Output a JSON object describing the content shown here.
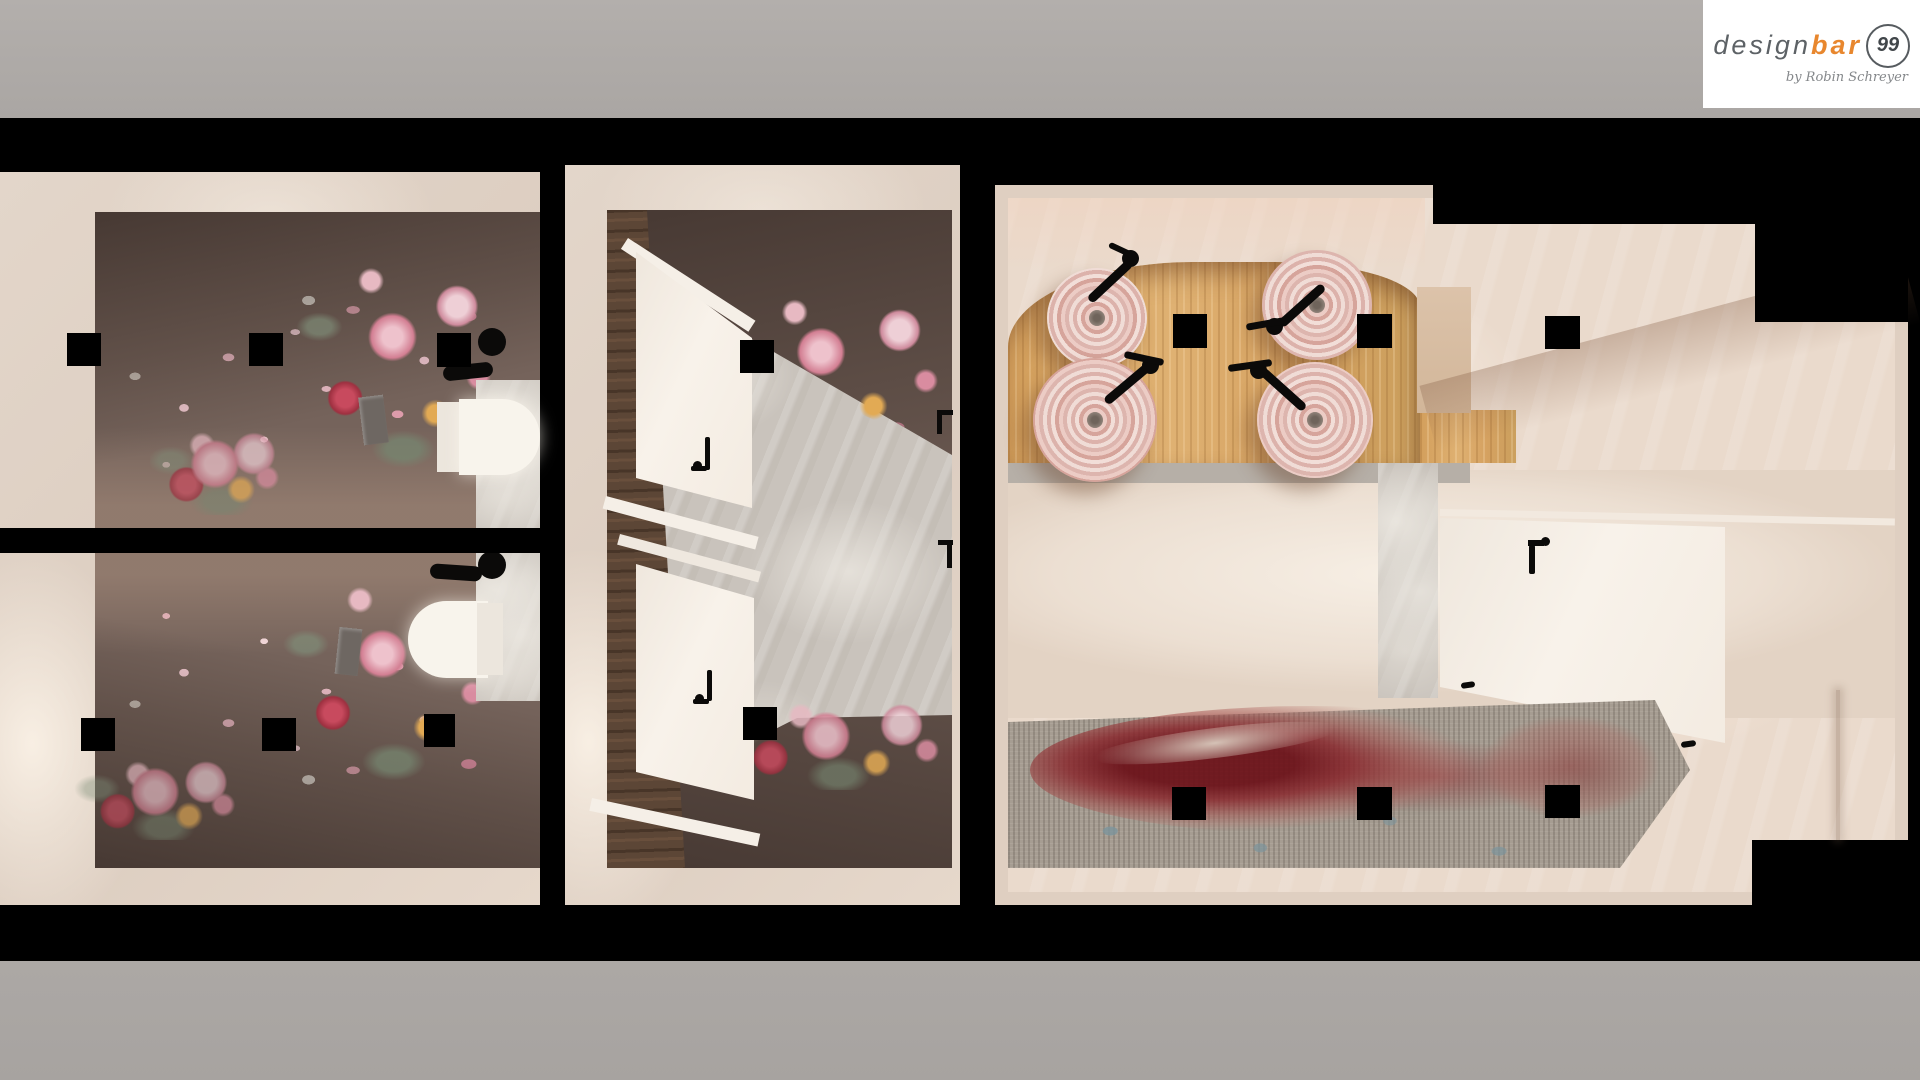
{
  "logo": {
    "word_design": "design",
    "word_bar": "bar",
    "number": "99",
    "byline": "by Robin Schreyer"
  },
  "palette": {
    "frame_gray_top": "#b1adaa",
    "frame_gray_bottom": "#a9a5a2",
    "background_black": "#000000",
    "logo_orange": "#e8872e",
    "logo_gray": "#5d6266",
    "plaster_cream": "#e9dbce",
    "wallpaper_mauve": "#75635b",
    "floral_pink": "#d98ca0",
    "wood_counter": "#d9a765",
    "wood_wall_brown": "#5c4636",
    "marble_gray": "#c9c3bc",
    "carpet_gray": "#a69d92",
    "carpet_red": "#8e2430",
    "sink_pink": "#e3bdb6",
    "fixture_black": "#171412",
    "toilet_white": "#f5f0e8"
  },
  "scene": {
    "view": "top-down interior render",
    "left_section": {
      "label": "toilet-stalls",
      "toilets": 2,
      "flush_plates": 2,
      "roll_holders": 2,
      "ceiling_lights": 6
    },
    "middle_section": {
      "label": "stall-lobby",
      "white_doors": 2,
      "ceiling_lights": 2
    },
    "right_section": {
      "label": "washroom-vanity",
      "sinks": 4,
      "faucets": 4,
      "ceiling_lights": 6,
      "carpet": "red-floral"
    }
  }
}
